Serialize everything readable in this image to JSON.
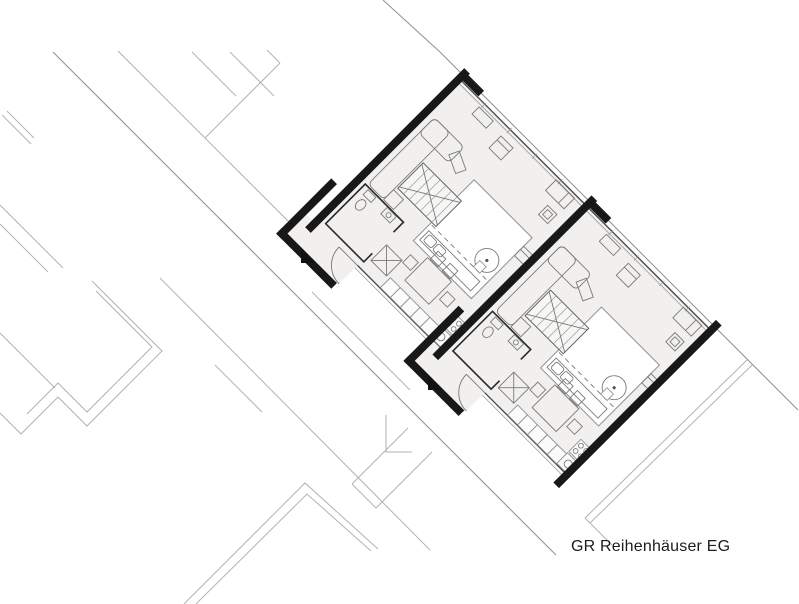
{
  "caption": "GR Reihenhäuser EG",
  "drawing": {
    "kind": "architectural-floor-plan",
    "unit_count": 2,
    "rotation_deg": 45,
    "room_icons": [
      "living-area",
      "stair",
      "patio-court",
      "kitchen",
      "dining-area",
      "bathroom",
      "entrance-porch"
    ],
    "furniture_icons": [
      "sofa-icon",
      "coffee-table-icon",
      "armchair-icon",
      "desk-icon",
      "plant-icon",
      "stair-icon",
      "dining-table-icon",
      "chair-icon",
      "kitchen-counter-icon",
      "stove-icon",
      "sink-icon",
      "wc-icon",
      "shower-icon",
      "entrance-arrow-icon",
      "door-swing-icon",
      "tree-icon",
      "bench-icon"
    ],
    "colors": {
      "background": "#ffffff",
      "wall": "#181818",
      "floor": "#f1f0ee",
      "court": "#ffffff",
      "context_line": "#b2b2b2",
      "context_line_dark": "#8f8f8f",
      "facade_line": "#474747",
      "facade_line_light": "#9a9a9a",
      "furniture_line": "#7a7a7a",
      "furniture_fill": "#fbfbfb",
      "bath_wall": "#2a2a2a",
      "caption_text": "#1c1c1c"
    }
  }
}
